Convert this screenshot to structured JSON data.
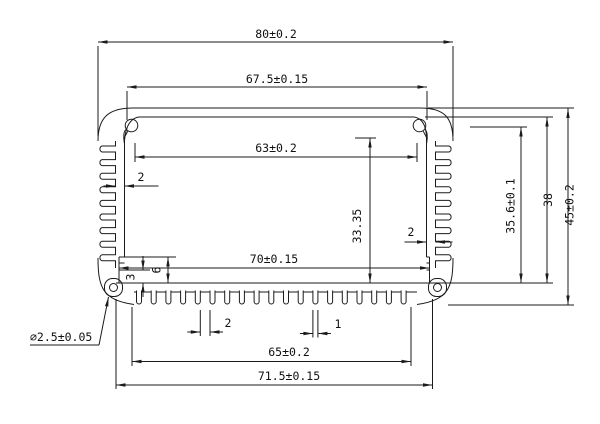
{
  "drawing": {
    "kind": "technical-dimension-drawing",
    "subject": "finned-extrusion-enclosure-cross-section",
    "line_color": "#1b1b1b",
    "background": "#ffffff",
    "dims": [
      {
        "id": "overall-width",
        "label": "80±0.2",
        "type": "h",
        "a": 98,
        "b": 453,
        "pos": 42,
        "tx": 276,
        "ty": 38,
        "mode": "in"
      },
      {
        "id": "opening-width",
        "label": "67.5±0.15",
        "type": "h",
        "a": 127,
        "b": 427,
        "pos": 87,
        "tx": 277,
        "ty": 83,
        "mode": "in"
      },
      {
        "id": "boss-span-width",
        "label": "63±0.2",
        "type": "h",
        "a": 135,
        "b": 417,
        "pos": 157,
        "tx": 276,
        "ty": 152,
        "mode": "in"
      },
      {
        "id": "bottom-inner-width",
        "label": "70±0.15",
        "type": "h",
        "a": 119,
        "b": 429.5,
        "pos": 268,
        "tx": 274,
        "ty": 263,
        "mode": "in"
      },
      {
        "id": "fin-field-width",
        "label": "65±0.2",
        "type": "h",
        "a": 132,
        "b": 411,
        "pos": 361.5,
        "tx": 289,
        "ty": 356,
        "mode": "in"
      },
      {
        "id": "base-width",
        "label": "71.5±0.15",
        "type": "h",
        "a": 116,
        "b": 432.5,
        "pos": 385,
        "tx": 289,
        "ty": 380,
        "mode": "in"
      },
      {
        "id": "left-wall-thickness",
        "label": "2",
        "type": "h",
        "a": 115.5,
        "b": 124.5,
        "pos": 186,
        "tx": 141,
        "ty": 181,
        "mode": "out",
        "ol": 12,
        "or": 34
      },
      {
        "id": "right-wall-thickness",
        "label": "2",
        "type": "h",
        "a": 426.5,
        "b": 435.5,
        "pos": 242,
        "tx": 411,
        "ty": 236,
        "mode": "out",
        "ol": 22,
        "or": 17
      },
      {
        "id": "bottom-fin-gap",
        "label": "2",
        "type": "h",
        "a": 200.3,
        "b": 210,
        "pos": 332,
        "tx": 228,
        "ty": 327,
        "mode": "out",
        "ol": 13,
        "or": 13
      },
      {
        "id": "bottom-fin-width",
        "label": "1",
        "type": "h",
        "a": 312.9,
        "b": 317.9,
        "pos": 333.5,
        "tx": 338,
        "ty": 328,
        "mode": "out",
        "ol": 13,
        "or": 13
      },
      {
        "id": "overall-height",
        "label": "45±0.2",
        "type": "v",
        "a": 108.5,
        "b": 305,
        "pos": 568,
        "tx": 573.5,
        "ty": 205,
        "mode": "in"
      },
      {
        "id": "cavity-height",
        "label": "38",
        "type": "v",
        "a": 117,
        "b": 283,
        "pos": 547,
        "tx": 552,
        "ty": 200,
        "mode": "in"
      },
      {
        "id": "boss-height",
        "label": "35.6±0.1",
        "type": "v",
        "a": 127,
        "b": 283,
        "pos": 521,
        "tx": 514.5,
        "ty": 206,
        "mode": "in"
      },
      {
        "id": "inner-height",
        "label": "33.35",
        "type": "v",
        "a": 138,
        "b": 283,
        "pos": 370,
        "tx": 361,
        "ty": 226,
        "mode": "in"
      },
      {
        "id": "slot-height",
        "label": "6",
        "type": "v",
        "a": 257,
        "b": 283,
        "pos": 168,
        "tx": 160.5,
        "ty": 270,
        "mode": "in"
      },
      {
        "id": "slot-lip-height",
        "label": "3",
        "type": "v",
        "a": 270,
        "b": 283,
        "pos": 143,
        "tx": 134.5,
        "ty": 277,
        "mode": "out",
        "ol": 14,
        "or": 14
      }
    ],
    "leader_note": {
      "id": "corner-hole-diameter",
      "label": "⌀2.5±0.05",
      "tx": 30,
      "ty": 341,
      "ux1": 30,
      "ux2": 99,
      "uy": 345,
      "lx1": 99,
      "ly1": 345,
      "lx2": 108.5,
      "ly2": 297
    },
    "ext_lines": [
      [
        98,
        46,
        98,
        136
      ],
      [
        453,
        46,
        453,
        136
      ],
      [
        127,
        91,
        127,
        120
      ],
      [
        427,
        91,
        427,
        120
      ],
      [
        135,
        143,
        135,
        162
      ],
      [
        417,
        143,
        417,
        162
      ],
      [
        355,
        138,
        376,
        138
      ],
      [
        470,
        127,
        527,
        127
      ],
      [
        425,
        117,
        553,
        117
      ],
      [
        428,
        108,
        574,
        108
      ],
      [
        448,
        305,
        574,
        305
      ],
      [
        432.5,
        283,
        553,
        283
      ],
      [
        124.5,
        257,
        176,
        257
      ],
      [
        119,
        270,
        150,
        270
      ],
      [
        200.3,
        310,
        200.3,
        336
      ],
      [
        210,
        310,
        210,
        336
      ],
      [
        312.9,
        310,
        312.9,
        337.5
      ],
      [
        317.9,
        310,
        317.9,
        337.5
      ],
      [
        132,
        307,
        132,
        366
      ],
      [
        411,
        307,
        411,
        366
      ],
      [
        116,
        299,
        116,
        389
      ],
      [
        432.5,
        299,
        432.5,
        389
      ],
      [
        426.5,
        233,
        426.5,
        250
      ]
    ],
    "profile": {
      "top_outline": "M98,141 C98,118 108,108 133,108 L420,108 C445,108 453,118 453,141",
      "top_plate_inner": [
        139,
        117,
        414,
        117
      ],
      "inner_fillets": [
        "M139,117 Q126,119 124.5,141",
        "M414,117 Q427,119 426.5,141"
      ],
      "bosses": [
        {
          "cx": 131.5,
          "cy": 125.5,
          "r": 6.3,
          "tail": "M124.5,144 Q122.5,132 126,129.5",
          "notch": "M127.8,131.2 L123.6,139"
        },
        {
          "cx": 419.5,
          "cy": 125.5,
          "r": 6.3,
          "tail": "M426.5,144 Q428.5,132 425,129.5",
          "notch": "M423.2,131.2 L427.4,139"
        }
      ],
      "side_fins": {
        "y0": 146,
        "pitch": 13.6,
        "h": 6,
        "n": 9,
        "face_top": 141,
        "face_bot": 268,
        "left_face": 115.5,
        "left_tip": 99,
        "right_face": 435.5,
        "right_tip": 452
      },
      "inner_faces": [
        [
          124.5,
          141,
          124.5,
          257
        ],
        [
          426.5,
          141,
          426.5,
          257
        ]
      ],
      "slots": {
        "ys": [
          257,
          263,
          270
        ],
        "lfloor": 119,
        "lface": 124.5,
        "rfloor": 429.5,
        "rface": 426.5,
        "ytop": 257,
        "ybot": 283
      },
      "bottom_inner": [
        116,
        283,
        432.5,
        283
      ],
      "bottom_outer_y": 292,
      "bottom_outer_x": [
        134,
        417
      ],
      "bottom_fins": {
        "x0": 136.5,
        "pitch": 14.7,
        "w": 5,
        "n": 19,
        "ytop": 290.5,
        "ytip": 301.5
      },
      "bottom_corners": [
        "M98,258 C98,288 103,300 134,304.5",
        "M453,258 C453,288 448,300 417,304.5"
      ],
      "feet": [
        {
          "x": 104.5,
          "y": 278.5,
          "w": 18,
          "h": 18,
          "r": 8
        },
        {
          "x": 428.5,
          "y": 278.5,
          "w": 18,
          "h": 18,
          "r": 8
        }
      ],
      "holes": [
        {
          "cx": 113.5,
          "cy": 287.5,
          "r": 4
        },
        {
          "cx": 437.5,
          "cy": 287.5,
          "r": 4
        }
      ]
    }
  }
}
